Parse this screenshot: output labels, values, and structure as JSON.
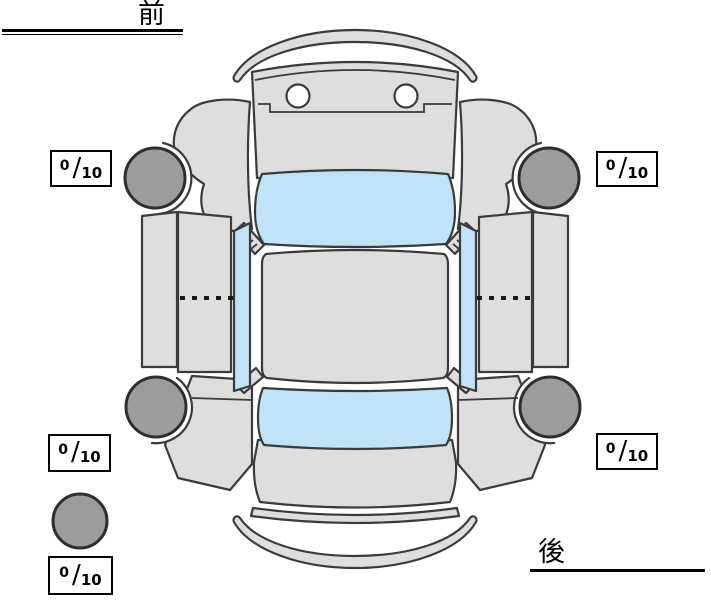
{
  "labels": {
    "front": "前",
    "rear": "後"
  },
  "ratings": {
    "front_left": {
      "value": "0",
      "separator": "/",
      "max": "10"
    },
    "front_right": {
      "value": "0",
      "separator": "/",
      "max": "10"
    },
    "rear_left": {
      "value": "0",
      "separator": "/",
      "max": "10"
    },
    "rear_right": {
      "value": "0",
      "separator": "/",
      "max": "10"
    },
    "spare": {
      "value": "0",
      "separator": "/",
      "max": "10"
    }
  },
  "colors": {
    "background": "#ffffff",
    "body_panel": "#dedede",
    "tire": "#9c9c9c",
    "glass": "#bfe3f7",
    "outline": "#3b3b3b",
    "text": "#000000"
  }
}
